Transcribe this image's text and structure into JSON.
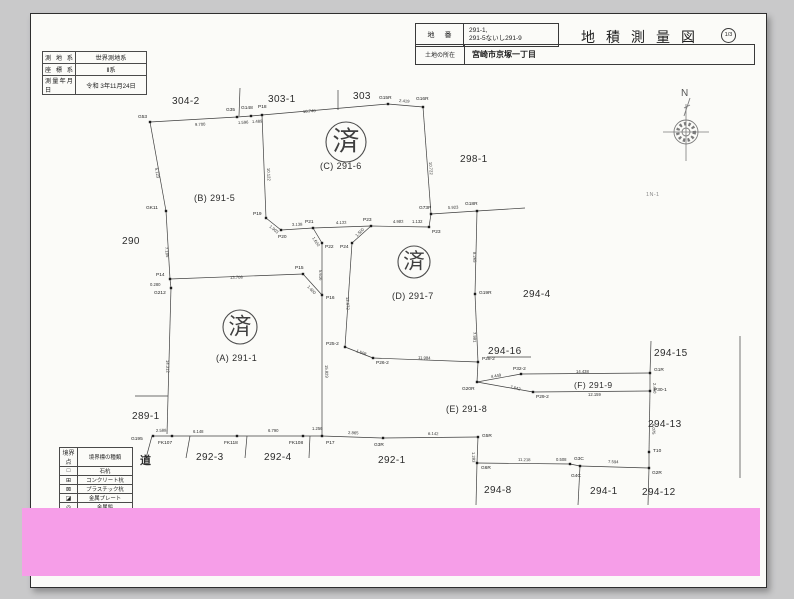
{
  "header": {
    "lot_label": "地番",
    "lot_value_line1": "291-1,",
    "lot_value_line2": "291-5ないし291-9",
    "title": "地積測量図",
    "sheet": "1/3",
    "location_label": "土地の所在",
    "location_value": "宮崎市京塚一丁目"
  },
  "meta_table": {
    "rows": [
      [
        "測地系",
        "世界測地系"
      ],
      [
        "座標系",
        "Ⅱ系"
      ],
      [
        "測量年月日",
        "令和 3年11月24日"
      ]
    ]
  },
  "legend": {
    "headers": [
      "境界点",
      "境界標の種類"
    ],
    "rows": [
      [
        "□",
        "石杭"
      ],
      [
        "⊞",
        "コンクリート杭"
      ],
      [
        "⊠",
        "プラスチック杭"
      ],
      [
        "◪",
        "金属プレート"
      ],
      [
        "◎",
        "金属鋲"
      ]
    ]
  },
  "compass": {
    "label": "N"
  },
  "colors": {
    "redaction_pink": "#f69ee8",
    "paper": "#fbfbf8",
    "background": "#c9c9ca",
    "line": "#3d3d3d"
  },
  "map": {
    "segments": [
      [
        150,
        122,
        237,
        117
      ],
      [
        237,
        117,
        251,
        116
      ],
      [
        251,
        116,
        262,
        115
      ],
      [
        262,
        115,
        388,
        104
      ],
      [
        388,
        104,
        423,
        107
      ],
      [
        240,
        88,
        239,
        116
      ],
      [
        338,
        90,
        338,
        110
      ],
      [
        423,
        107,
        431,
        214
      ],
      [
        431,
        214,
        477,
        211
      ],
      [
        477,
        211,
        525,
        208
      ],
      [
        431,
        214,
        429,
        227
      ],
      [
        429,
        227,
        371,
        226
      ],
      [
        371,
        226,
        313,
        228
      ],
      [
        313,
        228,
        281,
        230
      ],
      [
        281,
        230,
        266,
        218
      ],
      [
        266,
        218,
        262,
        115
      ],
      [
        313,
        228,
        322,
        243
      ],
      [
        371,
        226,
        352,
        243
      ],
      [
        322,
        243,
        322,
        295
      ],
      [
        352,
        243,
        345,
        347
      ],
      [
        345,
        347,
        373,
        358
      ],
      [
        373,
        358,
        478,
        362
      ],
      [
        477,
        211,
        475,
        294
      ],
      [
        475,
        294,
        478,
        362
      ],
      [
        478,
        362,
        477,
        382
      ],
      [
        477,
        382,
        521,
        374
      ],
      [
        521,
        374,
        650,
        373
      ],
      [
        477,
        382,
        533,
        392
      ],
      [
        533,
        392,
        650,
        391
      ],
      [
        650,
        373,
        650,
        391
      ],
      [
        651,
        341,
        650,
        373
      ],
      [
        650,
        391,
        649,
        452
      ],
      [
        649,
        452,
        649,
        468
      ],
      [
        649,
        468,
        648,
        505
      ],
      [
        150,
        122,
        166,
        211
      ],
      [
        166,
        211,
        170,
        279
      ],
      [
        170,
        279,
        303,
        274
      ],
      [
        303,
        274,
        322,
        295
      ],
      [
        170,
        279,
        171,
        288
      ],
      [
        171,
        288,
        167,
        434
      ],
      [
        153,
        436,
        322,
        436
      ],
      [
        322,
        295,
        322,
        436
      ],
      [
        152,
        436,
        146,
        458
      ],
      [
        190,
        436,
        186,
        458
      ],
      [
        247,
        436,
        245,
        458
      ],
      [
        310,
        436,
        309,
        458
      ],
      [
        322,
        436,
        383,
        438
      ],
      [
        383,
        438,
        478,
        437
      ],
      [
        478,
        437,
        477,
        463
      ],
      [
        477,
        463,
        570,
        464
      ],
      [
        570,
        464,
        580,
        466
      ],
      [
        580,
        466,
        649,
        468
      ],
      [
        477,
        463,
        476,
        505
      ],
      [
        580,
        466,
        578,
        505
      ],
      [
        740,
        336,
        740,
        478
      ],
      [
        135,
        396,
        168,
        396
      ],
      [
        487,
        357,
        531,
        357
      ]
    ],
    "points": [
      {
        "n": "G53",
        "x": 150,
        "y": 122,
        "lx": 138,
        "ly": 118
      },
      {
        "n": "G35",
        "x": 237,
        "y": 117,
        "lx": 226,
        "ly": 111
      },
      {
        "n": "G148",
        "x": 251,
        "y": 116,
        "lx": 241,
        "ly": 109
      },
      {
        "n": "P18",
        "x": 262,
        "y": 115,
        "lx": 258,
        "ly": 108
      },
      {
        "n": "G15R",
        "x": 388,
        "y": 104,
        "lx": 379,
        "ly": 99
      },
      {
        "n": "G16R",
        "x": 423,
        "y": 107,
        "lx": 416,
        "ly": 100
      },
      {
        "n": "G73P",
        "x": 431,
        "y": 214,
        "lx": 419,
        "ly": 209
      },
      {
        "n": "G18R",
        "x": 477,
        "y": 211,
        "lx": 465,
        "ly": 205
      },
      {
        "n": "P19",
        "x": 266,
        "y": 218,
        "lx": 253,
        "ly": 215
      },
      {
        "n": "P20",
        "x": 281,
        "y": 230,
        "lx": 278,
        "ly": 238
      },
      {
        "n": "P21",
        "x": 313,
        "y": 228,
        "lx": 305,
        "ly": 223
      },
      {
        "n": "P22",
        "x": 322,
        "y": 243,
        "lx": 325,
        "ly": 248
      },
      {
        "n": "P23",
        "x": 371,
        "y": 226,
        "lx": 363,
        "ly": 221
      },
      {
        "n": "P24",
        "x": 352,
        "y": 243,
        "lx": 340,
        "ly": 248
      },
      {
        "n": "P23",
        "x": 429,
        "y": 227,
        "lx": 432,
        "ly": 233
      },
      {
        "n": "GK11",
        "x": 166,
        "y": 211,
        "lx": 146,
        "ly": 209
      },
      {
        "n": "P14",
        "x": 170,
        "y": 279,
        "lx": 156,
        "ly": 276
      },
      {
        "n": "G212",
        "x": 171,
        "y": 288,
        "lx": 154,
        "ly": 294
      },
      {
        "n": "P15",
        "x": 303,
        "y": 274,
        "lx": 295,
        "ly": 269
      },
      {
        "n": "P16",
        "x": 322,
        "y": 295,
        "lx": 326,
        "ly": 299
      },
      {
        "n": "G195",
        "x": 153,
        "y": 436,
        "lx": 131,
        "ly": 440
      },
      {
        "n": "FK107",
        "x": 172,
        "y": 436,
        "lx": 158,
        "ly": 444
      },
      {
        "n": "FK118",
        "x": 237,
        "y": 436,
        "lx": 224,
        "ly": 444
      },
      {
        "n": "FK108",
        "x": 303,
        "y": 436,
        "lx": 289,
        "ly": 444
      },
      {
        "n": "P17",
        "x": 322,
        "y": 436,
        "lx": 326,
        "ly": 444
      },
      {
        "n": "G19R",
        "x": 475,
        "y": 294,
        "lx": 479,
        "ly": 294
      },
      {
        "n": "P28-2",
        "x": 478,
        "y": 362,
        "lx": 482,
        "ly": 360
      },
      {
        "n": "G20R",
        "x": 477,
        "y": 382,
        "lx": 462,
        "ly": 390
      },
      {
        "n": "P25-2",
        "x": 345,
        "y": 347,
        "lx": 326,
        "ly": 345
      },
      {
        "n": "P26-2",
        "x": 373,
        "y": 358,
        "lx": 376,
        "ly": 364
      },
      {
        "n": "P32-2",
        "x": 521,
        "y": 374,
        "lx": 513,
        "ly": 370
      },
      {
        "n": "G1R",
        "x": 650,
        "y": 373,
        "lx": 654,
        "ly": 371
      },
      {
        "n": "P29-2",
        "x": 533,
        "y": 392,
        "lx": 536,
        "ly": 398
      },
      {
        "n": "P30-1",
        "x": 650,
        "y": 391,
        "lx": 654,
        "ly": 391
      },
      {
        "n": "T10",
        "x": 649,
        "y": 452,
        "lx": 653,
        "ly": 452
      },
      {
        "n": "G2R",
        "x": 649,
        "y": 468,
        "lx": 652,
        "ly": 474
      },
      {
        "n": "G3R",
        "x": 383,
        "y": 438,
        "lx": 374,
        "ly": 446
      },
      {
        "n": "G5R",
        "x": 478,
        "y": 437,
        "lx": 482,
        "ly": 437
      },
      {
        "n": "G6R",
        "x": 477,
        "y": 463,
        "lx": 481,
        "ly": 469
      },
      {
        "n": "G3C",
        "x": 570,
        "y": 464,
        "lx": 574,
        "ly": 460
      },
      {
        "n": "G4C",
        "x": 580,
        "y": 466,
        "lx": 571,
        "ly": 477
      }
    ],
    "distances": [
      {
        "t": "9.700",
        "x": 195,
        "y": 126,
        "r": -3
      },
      {
        "t": "1.596",
        "x": 238,
        "y": 124,
        "r": -3
      },
      {
        "t": "1.489",
        "x": 252,
        "y": 123,
        "r": -3
      },
      {
        "t": "10.740",
        "x": 303,
        "y": 113,
        "r": -4
      },
      {
        "t": "2.419",
        "x": 399,
        "y": 102,
        "r": 4
      },
      {
        "t": "10.122",
        "x": 267,
        "y": 168,
        "r": 87
      },
      {
        "t": "10.722",
        "x": 429,
        "y": 162,
        "r": 86
      },
      {
        "t": "5.923",
        "x": 448,
        "y": 209,
        "r": -3
      },
      {
        "t": "1.132",
        "x": 412,
        "y": 223,
        "r": 0
      },
      {
        "t": "4.983",
        "x": 393,
        "y": 223,
        "r": -1
      },
      {
        "t": "4.133",
        "x": 336,
        "y": 224,
        "r": -1
      },
      {
        "t": "3.138",
        "x": 292,
        "y": 226,
        "r": -2
      },
      {
        "t": "1.903",
        "x": 269,
        "y": 227,
        "r": 40
      },
      {
        "t": "1.600",
        "x": 312,
        "y": 238,
        "r": 57
      },
      {
        "t": "1.500",
        "x": 357,
        "y": 237,
        "r": -45
      },
      {
        "t": "5.616",
        "x": 319,
        "y": 270,
        "r": 88
      },
      {
        "t": "12.672",
        "x": 346,
        "y": 297,
        "r": 87
      },
      {
        "t": "5.123",
        "x": 155,
        "y": 168,
        "r": 80
      },
      {
        "t": "7.185",
        "x": 165,
        "y": 247,
        "r": 84
      },
      {
        "t": "13.708",
        "x": 230,
        "y": 279,
        "r": -2
      },
      {
        "t": "0.280",
        "x": 150,
        "y": 286,
        "r": 0
      },
      {
        "t": "1.600",
        "x": 307,
        "y": 287,
        "r": 46
      },
      {
        "t": "14.312",
        "x": 166,
        "y": 360,
        "r": 88
      },
      {
        "t": "15.829",
        "x": 325,
        "y": 365,
        "r": 88
      },
      {
        "t": "2.588",
        "x": 156,
        "y": 432,
        "r": -2
      },
      {
        "t": "6.148",
        "x": 193,
        "y": 433,
        "r": 0
      },
      {
        "t": "6.790",
        "x": 268,
        "y": 432,
        "r": 0
      },
      {
        "t": "1.256",
        "x": 312,
        "y": 430,
        "r": 0
      },
      {
        "t": "8.265",
        "x": 473,
        "y": 252,
        "r": 88
      },
      {
        "t": "7.981",
        "x": 473,
        "y": 332,
        "r": 88
      },
      {
        "t": "1.508",
        "x": 356,
        "y": 352,
        "r": 20
      },
      {
        "t": "11.984",
        "x": 418,
        "y": 359,
        "r": 2
      },
      {
        "t": "4.449",
        "x": 491,
        "y": 378,
        "r": -9
      },
      {
        "t": "14.438",
        "x": 576,
        "y": 373,
        "r": 0
      },
      {
        "t": "7.642",
        "x": 510,
        "y": 388,
        "r": 14
      },
      {
        "t": "12.159",
        "x": 588,
        "y": 396,
        "r": 0
      },
      {
        "t": "2.460",
        "x": 653,
        "y": 383,
        "r": 88
      },
      {
        "t": "6.075",
        "x": 652,
        "y": 424,
        "r": 88
      },
      {
        "t": "2.865",
        "x": 348,
        "y": 434,
        "r": 2
      },
      {
        "t": "6.142",
        "x": 428,
        "y": 435,
        "r": 1
      },
      {
        "t": "1.283",
        "x": 472,
        "y": 452,
        "r": 88
      },
      {
        "t": "11.218",
        "x": 518,
        "y": 461,
        "r": 1
      },
      {
        "t": "0.508",
        "x": 556,
        "y": 461,
        "r": 0
      },
      {
        "t": "7.594",
        "x": 608,
        "y": 463,
        "r": 2
      }
    ],
    "parcels": [
      {
        "t": "304-2",
        "x": 172,
        "y": 104,
        "s": 10
      },
      {
        "t": "303-1",
        "x": 268,
        "y": 102,
        "s": 10
      },
      {
        "t": "303",
        "x": 353,
        "y": 99,
        "s": 10
      },
      {
        "t": "298-1",
        "x": 460,
        "y": 162,
        "s": 10
      },
      {
        "t": "290",
        "x": 122,
        "y": 244,
        "s": 10
      },
      {
        "t": "(B) 291-5",
        "x": 194,
        "y": 201,
        "s": 9
      },
      {
        "t": "(C) 291-6",
        "x": 320,
        "y": 169,
        "s": 9
      },
      {
        "t": "(D) 291-7",
        "x": 392,
        "y": 299,
        "s": 9
      },
      {
        "t": "(A) 291-1",
        "x": 216,
        "y": 361,
        "s": 9
      },
      {
        "t": "289-1",
        "x": 132,
        "y": 419,
        "s": 10
      },
      {
        "t": "294-4",
        "x": 523,
        "y": 297,
        "s": 10
      },
      {
        "t": "294-16",
        "x": 488,
        "y": 354,
        "s": 10
      },
      {
        "t": "294-15",
        "x": 654,
        "y": 356,
        "s": 10
      },
      {
        "t": "(F) 291-9",
        "x": 574,
        "y": 388,
        "s": 8.5
      },
      {
        "t": "(E) 291-8",
        "x": 446,
        "y": 412,
        "s": 9
      },
      {
        "t": "294-13",
        "x": 648,
        "y": 427,
        "s": 10
      },
      {
        "t": "292-3",
        "x": 196,
        "y": 460,
        "s": 10
      },
      {
        "t": "292-4",
        "x": 264,
        "y": 460,
        "s": 10
      },
      {
        "t": "292-1",
        "x": 378,
        "y": 463,
        "s": 10
      },
      {
        "t": "294-8",
        "x": 484,
        "y": 493,
        "s": 10
      },
      {
        "t": "294-1",
        "x": 590,
        "y": 494,
        "s": 10
      },
      {
        "t": "294-12",
        "x": 642,
        "y": 495,
        "s": 10
      },
      {
        "t": "道",
        "x": 140,
        "y": 464,
        "s": 11,
        "b": true
      },
      {
        "t": "1N-1",
        "x": 646,
        "y": 196,
        "s": 5.5,
        "c": "faint"
      }
    ],
    "stamps": [
      {
        "char": "済",
        "x": 346,
        "y": 142,
        "r": 20
      },
      {
        "char": "済",
        "x": 414,
        "y": 262,
        "r": 16
      },
      {
        "char": "済",
        "x": 240,
        "y": 327,
        "r": 17
      }
    ]
  }
}
